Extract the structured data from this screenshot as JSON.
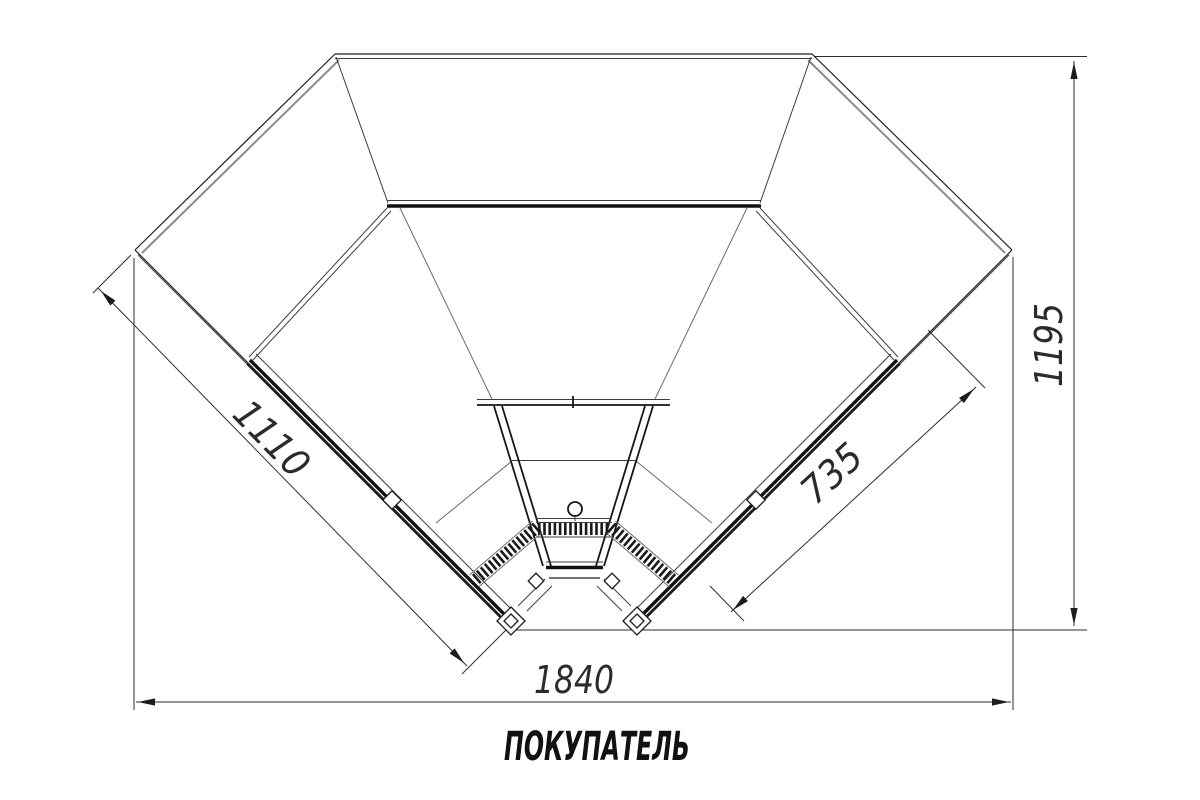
{
  "drawing": {
    "view": "plan-top-view-corner-showcase",
    "dimensions": {
      "left_front_mm": "1110",
      "right_front_mm": "735",
      "depth_mm": "1195",
      "width_mm": "1840"
    },
    "customer_side_label": "ПОКУПАТЕЛЬ",
    "colors": {
      "line": "#1c1c1c",
      "dimension_line": "#2e2e2e",
      "text": "#2b2b2b",
      "background": "#ffffff"
    }
  }
}
